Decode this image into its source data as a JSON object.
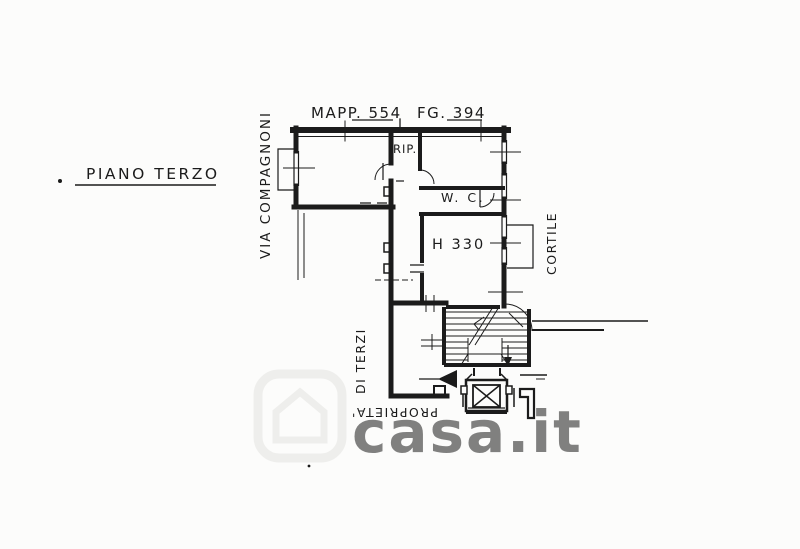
{
  "plan": {
    "title": "PIANO TERZO",
    "street_label": "VIA COMPAGNONI",
    "cadastral": {
      "map_ref": "MAPP. 554",
      "sheet_ref": "FG. 394"
    },
    "rooms": {
      "storage_label": "RIP.",
      "wc_label": "W. C.",
      "height_label": "H 330"
    },
    "courtyard_label": "CORTILE",
    "boundary_label_top": "DI TERZI",
    "boundary_label_bottom": "PROPRIETA'"
  },
  "watermark": {
    "text": "casa.it"
  },
  "colors": {
    "ink": "#1b1b1b",
    "paper": "#fcfcfb",
    "watermark": "#e4e4e0"
  }
}
